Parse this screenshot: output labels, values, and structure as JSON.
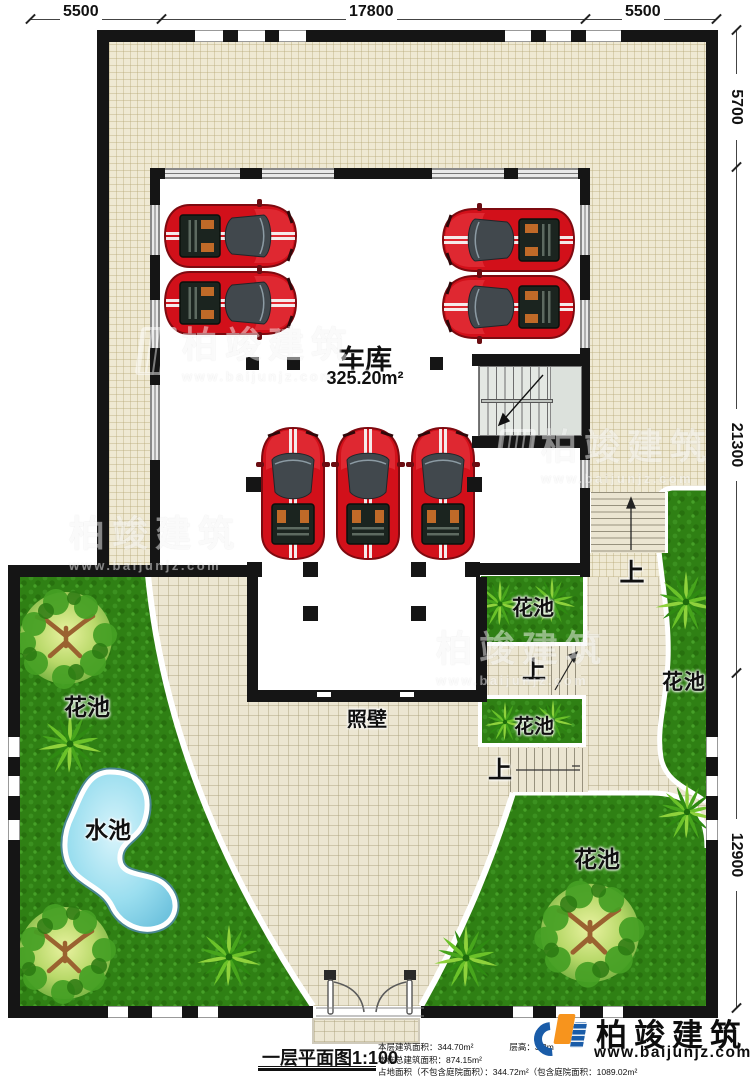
{
  "dimensions": {
    "top": [
      "5500",
      "17800",
      "5500"
    ],
    "right": [
      "5700",
      "21300",
      "12900"
    ]
  },
  "labels": {
    "garage": "车库",
    "garage_area": "325.20m²",
    "screen_wall": "照壁",
    "flower_pool": "花池",
    "water_pool": "水池",
    "up": "上"
  },
  "footer": {
    "title": "一层平面图1:100",
    "info_line1a": "本层建筑面积：344.70m²",
    "info_line1b": "层高：3.3m",
    "info_line2": "本栋总建筑面积：874.15m²",
    "info_line3": "占地面积（不包含庭院面积）：344.72m²（包含庭院面积：1089.02m²"
  },
  "branding": {
    "name": "柏竣建筑",
    "website": "www.baijunjz.com"
  },
  "colors": {
    "grass": "#2f8014",
    "tile": "#efe9d3",
    "wall": "#151515",
    "car_red": "#d2101a",
    "water": "#9adeef",
    "brand_blue": "#1a5ca8",
    "brand_orange": "#f7941d"
  }
}
